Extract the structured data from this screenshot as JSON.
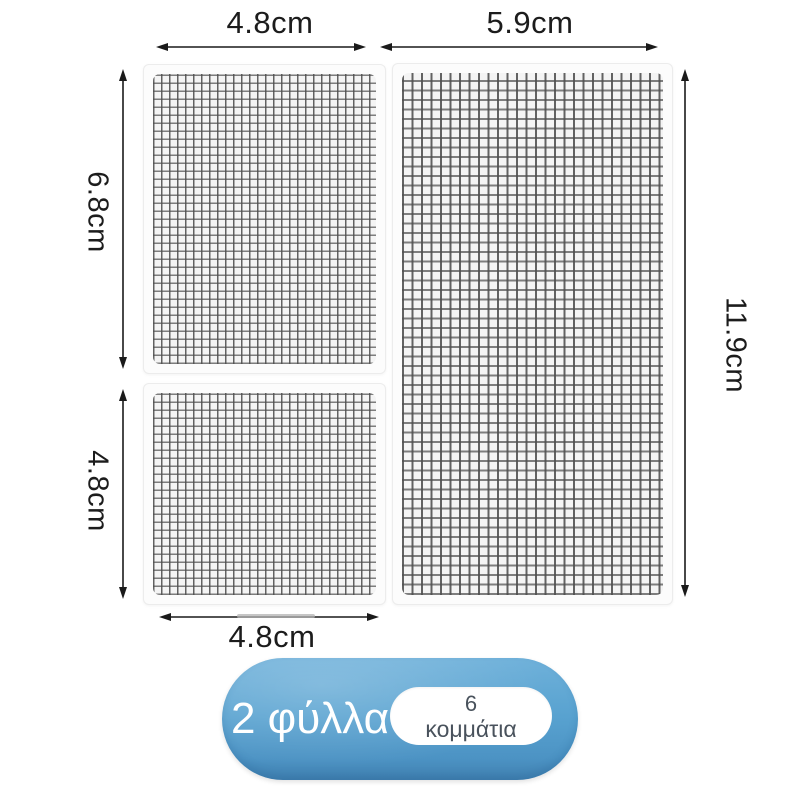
{
  "product": {
    "type": "mesh-repair-patch-infographic",
    "panels": [
      {
        "id": "top-left",
        "width_label": "4.8cm",
        "height_label": "6.8cm"
      },
      {
        "id": "right",
        "width_label": "5.9cm",
        "height_label": "11.9cm"
      },
      {
        "id": "bottom-left",
        "width_label": "4.8cm",
        "height_label": "4.8cm"
      }
    ],
    "dimensions": {
      "top_left_width": "4.8cm",
      "top_right_width": "5.9cm",
      "left_top_height": "6.8cm",
      "left_bottom_height": "4.8cm",
      "right_height": "11.9cm",
      "bottom_width": "4.8cm"
    },
    "badge": {
      "sheets_label": "2 φύλλα",
      "pieces_count": "6",
      "pieces_label": "κομμάτια",
      "bg_color": "#58a2d0",
      "text_color": "#ffffff",
      "inner_bg_color": "#ffffff",
      "inner_text_color": "#49525c"
    },
    "colors": {
      "background": "#ffffff",
      "panel_bg": "#fcfcfc",
      "panel_border": "#ececec",
      "mesh_bg": "#f4f4f4",
      "mesh_line": "#4e4e4e",
      "arrow": "#1a1a1a",
      "label_text": "#1c1c1c"
    }
  }
}
